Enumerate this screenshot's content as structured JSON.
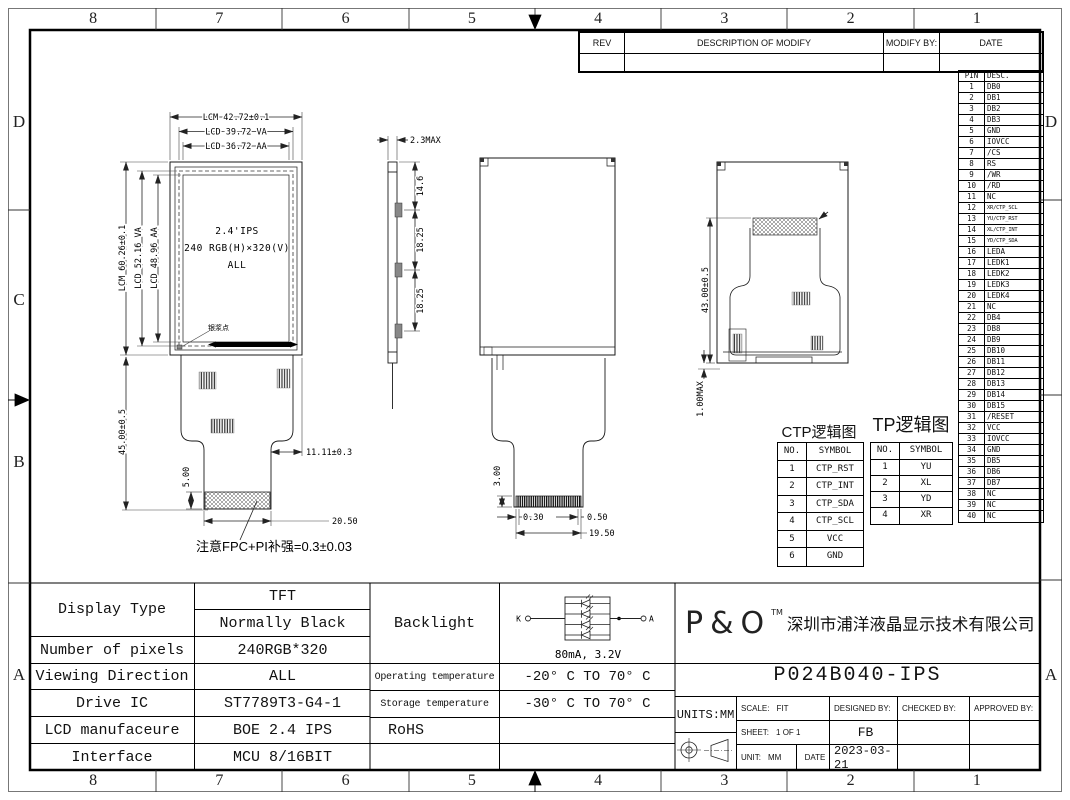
{
  "sheet_border": {
    "columns": [
      "8",
      "7",
      "6",
      "5",
      "4",
      "3",
      "2",
      "1"
    ],
    "rows_left": [
      "D",
      "C",
      "B",
      "A"
    ]
  },
  "rev_table": {
    "rev": "REV",
    "description": "DESCRIPTION OF MODIFY",
    "modify_by": "MODIFY BY:",
    "date": "DATE"
  },
  "pin_table": {
    "pin_header": "PIN",
    "desc_header": "DESC.",
    "pins": [
      [
        "1",
        "DB0"
      ],
      [
        "2",
        "DB1"
      ],
      [
        "3",
        "DB2"
      ],
      [
        "4",
        "DB3"
      ],
      [
        "5",
        "GND"
      ],
      [
        "6",
        "IOVCC"
      ],
      [
        "7",
        "/CS"
      ],
      [
        "8",
        "RS"
      ],
      [
        "9",
        "/WR"
      ],
      [
        "10",
        "/RD"
      ],
      [
        "11",
        "NC"
      ],
      [
        "12",
        "XR/CTP_SCL"
      ],
      [
        "13",
        "YU/CTP_RST"
      ],
      [
        "14",
        "XL/CTP_INT"
      ],
      [
        "15",
        "YD/CTP_SDA"
      ],
      [
        "16",
        "LEDA"
      ],
      [
        "17",
        "LEDK1"
      ],
      [
        "18",
        "LEDK2"
      ],
      [
        "19",
        "LEDK3"
      ],
      [
        "20",
        "LEDK4"
      ],
      [
        "21",
        "NC"
      ],
      [
        "22",
        "DB4"
      ],
      [
        "23",
        "DB8"
      ],
      [
        "24",
        "DB9"
      ],
      [
        "25",
        "DB10"
      ],
      [
        "26",
        "DB11"
      ],
      [
        "27",
        "DB12"
      ],
      [
        "28",
        "DB13"
      ],
      [
        "29",
        "DB14"
      ],
      [
        "30",
        "DB15"
      ],
      [
        "31",
        "/RESET"
      ],
      [
        "32",
        "VCC"
      ],
      [
        "33",
        "IOVCC"
      ],
      [
        "34",
        "GND"
      ],
      [
        "35",
        "DB5"
      ],
      [
        "36",
        "DB6"
      ],
      [
        "37",
        "DB7"
      ],
      [
        "38",
        "NC"
      ],
      [
        "39",
        "NC"
      ],
      [
        "40",
        "NC"
      ]
    ]
  },
  "ctp_table": {
    "title": "CTP逻辑图",
    "no_header": "NO.",
    "symbol_header": "SYMBOL",
    "rows": [
      [
        "1",
        "CTP_RST"
      ],
      [
        "2",
        "CTP_INT"
      ],
      [
        "3",
        "CTP_SDA"
      ],
      [
        "4",
        "CTP_SCL"
      ],
      [
        "5",
        "VCC"
      ],
      [
        "6",
        "GND"
      ]
    ]
  },
  "tp_table": {
    "title": "TP逻辑图",
    "no_header": "NO.",
    "symbol_header": "SYMBOL",
    "rows": [
      [
        "1",
        "YU"
      ],
      [
        "2",
        "XL"
      ],
      [
        "3",
        "YD"
      ],
      [
        "4",
        "XR"
      ]
    ]
  },
  "front_view": {
    "dim_width_lcm": "LCM 42.72±0.1",
    "dim_width_va": "LCD 39.72 VA",
    "dim_width_aa": "LCD 36.72 AA",
    "dim_height_lcm": "LCM 60.26±0.1",
    "dim_height_va": "LCD 52.16 VA",
    "dim_height_aa": "LCD 48.96 AA",
    "dim_fpc_length": "45.00±0.5",
    "dim_connector_inset": "11.11±0.3",
    "dim_stiffener_height": "5.00",
    "dim_connector_width": "20.50",
    "panel_line1": "2.4'IPS",
    "panel_line2": "240 RGB(H)×320(V)",
    "panel_line3": "ALL",
    "silver_dot_label": "银浆点",
    "fpc_note": "注意FPC+PI补强=0.3±0.03"
  },
  "side_view": {
    "dim_thickness": "2.3MAX",
    "dim_top": "14.6",
    "dim_mid": "18.25",
    "dim_bottom": "18.25"
  },
  "back_view": {
    "dim_tail": "3.00",
    "dim_left_margin": "0.30",
    "dim_right_margin": "0.50",
    "dim_connector_width": "19.50"
  },
  "rear_view": {
    "dim_height": "43.00±0.5",
    "dim_fold": "1.00MAX"
  },
  "spec_table": {
    "display_type_label": "Display Type",
    "display_type_value1": "TFT",
    "display_type_value2": "Normally Black",
    "pixels_label": "Number of pixels",
    "pixels_value": "240RGB*320",
    "viewing_label": "Viewing Direction",
    "viewing_value": "ALL",
    "drive_ic_label": "Drive IC",
    "drive_ic_value": "ST7789T3-G4-1",
    "manufacture_label": "LCD manufaceure",
    "manufacture_value": "BOE 2.4 IPS",
    "interface_label": "Interface",
    "interface_value": "MCU 8/16BIT"
  },
  "env_table": {
    "backlight_label": "Backlight",
    "backlight_k": "K",
    "backlight_a": "A",
    "backlight_rating": "80mA, 3.2V",
    "operating_label": "Operating temperature",
    "operating_value": "-20° C TO 70° C",
    "storage_label": "Storage temperature",
    "storage_value": "-30° C TO 70° C",
    "rohs_label": "RoHS"
  },
  "title_block": {
    "logo": "P&O",
    "trademark": "TM",
    "company": "深圳市浦洋液晶显示技术有限公司",
    "part_number": "P024B040-IPS",
    "units": "UNITS:MM",
    "scale_label": "SCALE:",
    "scale_value": "FIT",
    "designed_by_label": "DESIGNED BY:",
    "checked_by_label": "CHECKED BY:",
    "approved_by_label": "APPROVED BY:",
    "sheet_label": "SHEET:",
    "sheet_value": "1 OF 1",
    "designer": "FB",
    "unit_label": "UNIT:",
    "unit_value": "MM",
    "date_label": "DATE",
    "date_value": "2023-03-21"
  }
}
